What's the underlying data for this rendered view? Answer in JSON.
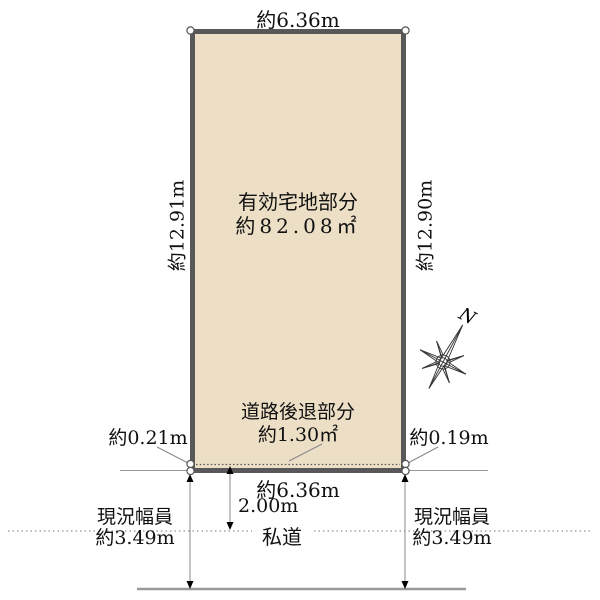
{
  "colors": {
    "plot_fill": "#ecdfc6",
    "plot_border": "#58585a",
    "thin_line": "#888888",
    "text": "#111111"
  },
  "plot": {
    "area_label_line1": "有効宅地部分",
    "area_label_line2": "約82.08㎡",
    "top_width": "約6.36m",
    "left_length": "約12.91m",
    "right_length": "約12.90m"
  },
  "setback": {
    "label_line1": "道路後退部分",
    "label_line2": "約1.30㎡",
    "left_offset": "約0.21m",
    "right_offset": "約0.19m"
  },
  "road": {
    "frontage_width": "約6.36m",
    "setback_distance": "2.00m",
    "name": "私道",
    "left_width": {
      "line1": "現況幅員",
      "line2": "約3.49m"
    },
    "right_width": {
      "line1": "現況幅員",
      "line2": "約3.49m"
    }
  },
  "compass": {
    "north_label": "N"
  }
}
